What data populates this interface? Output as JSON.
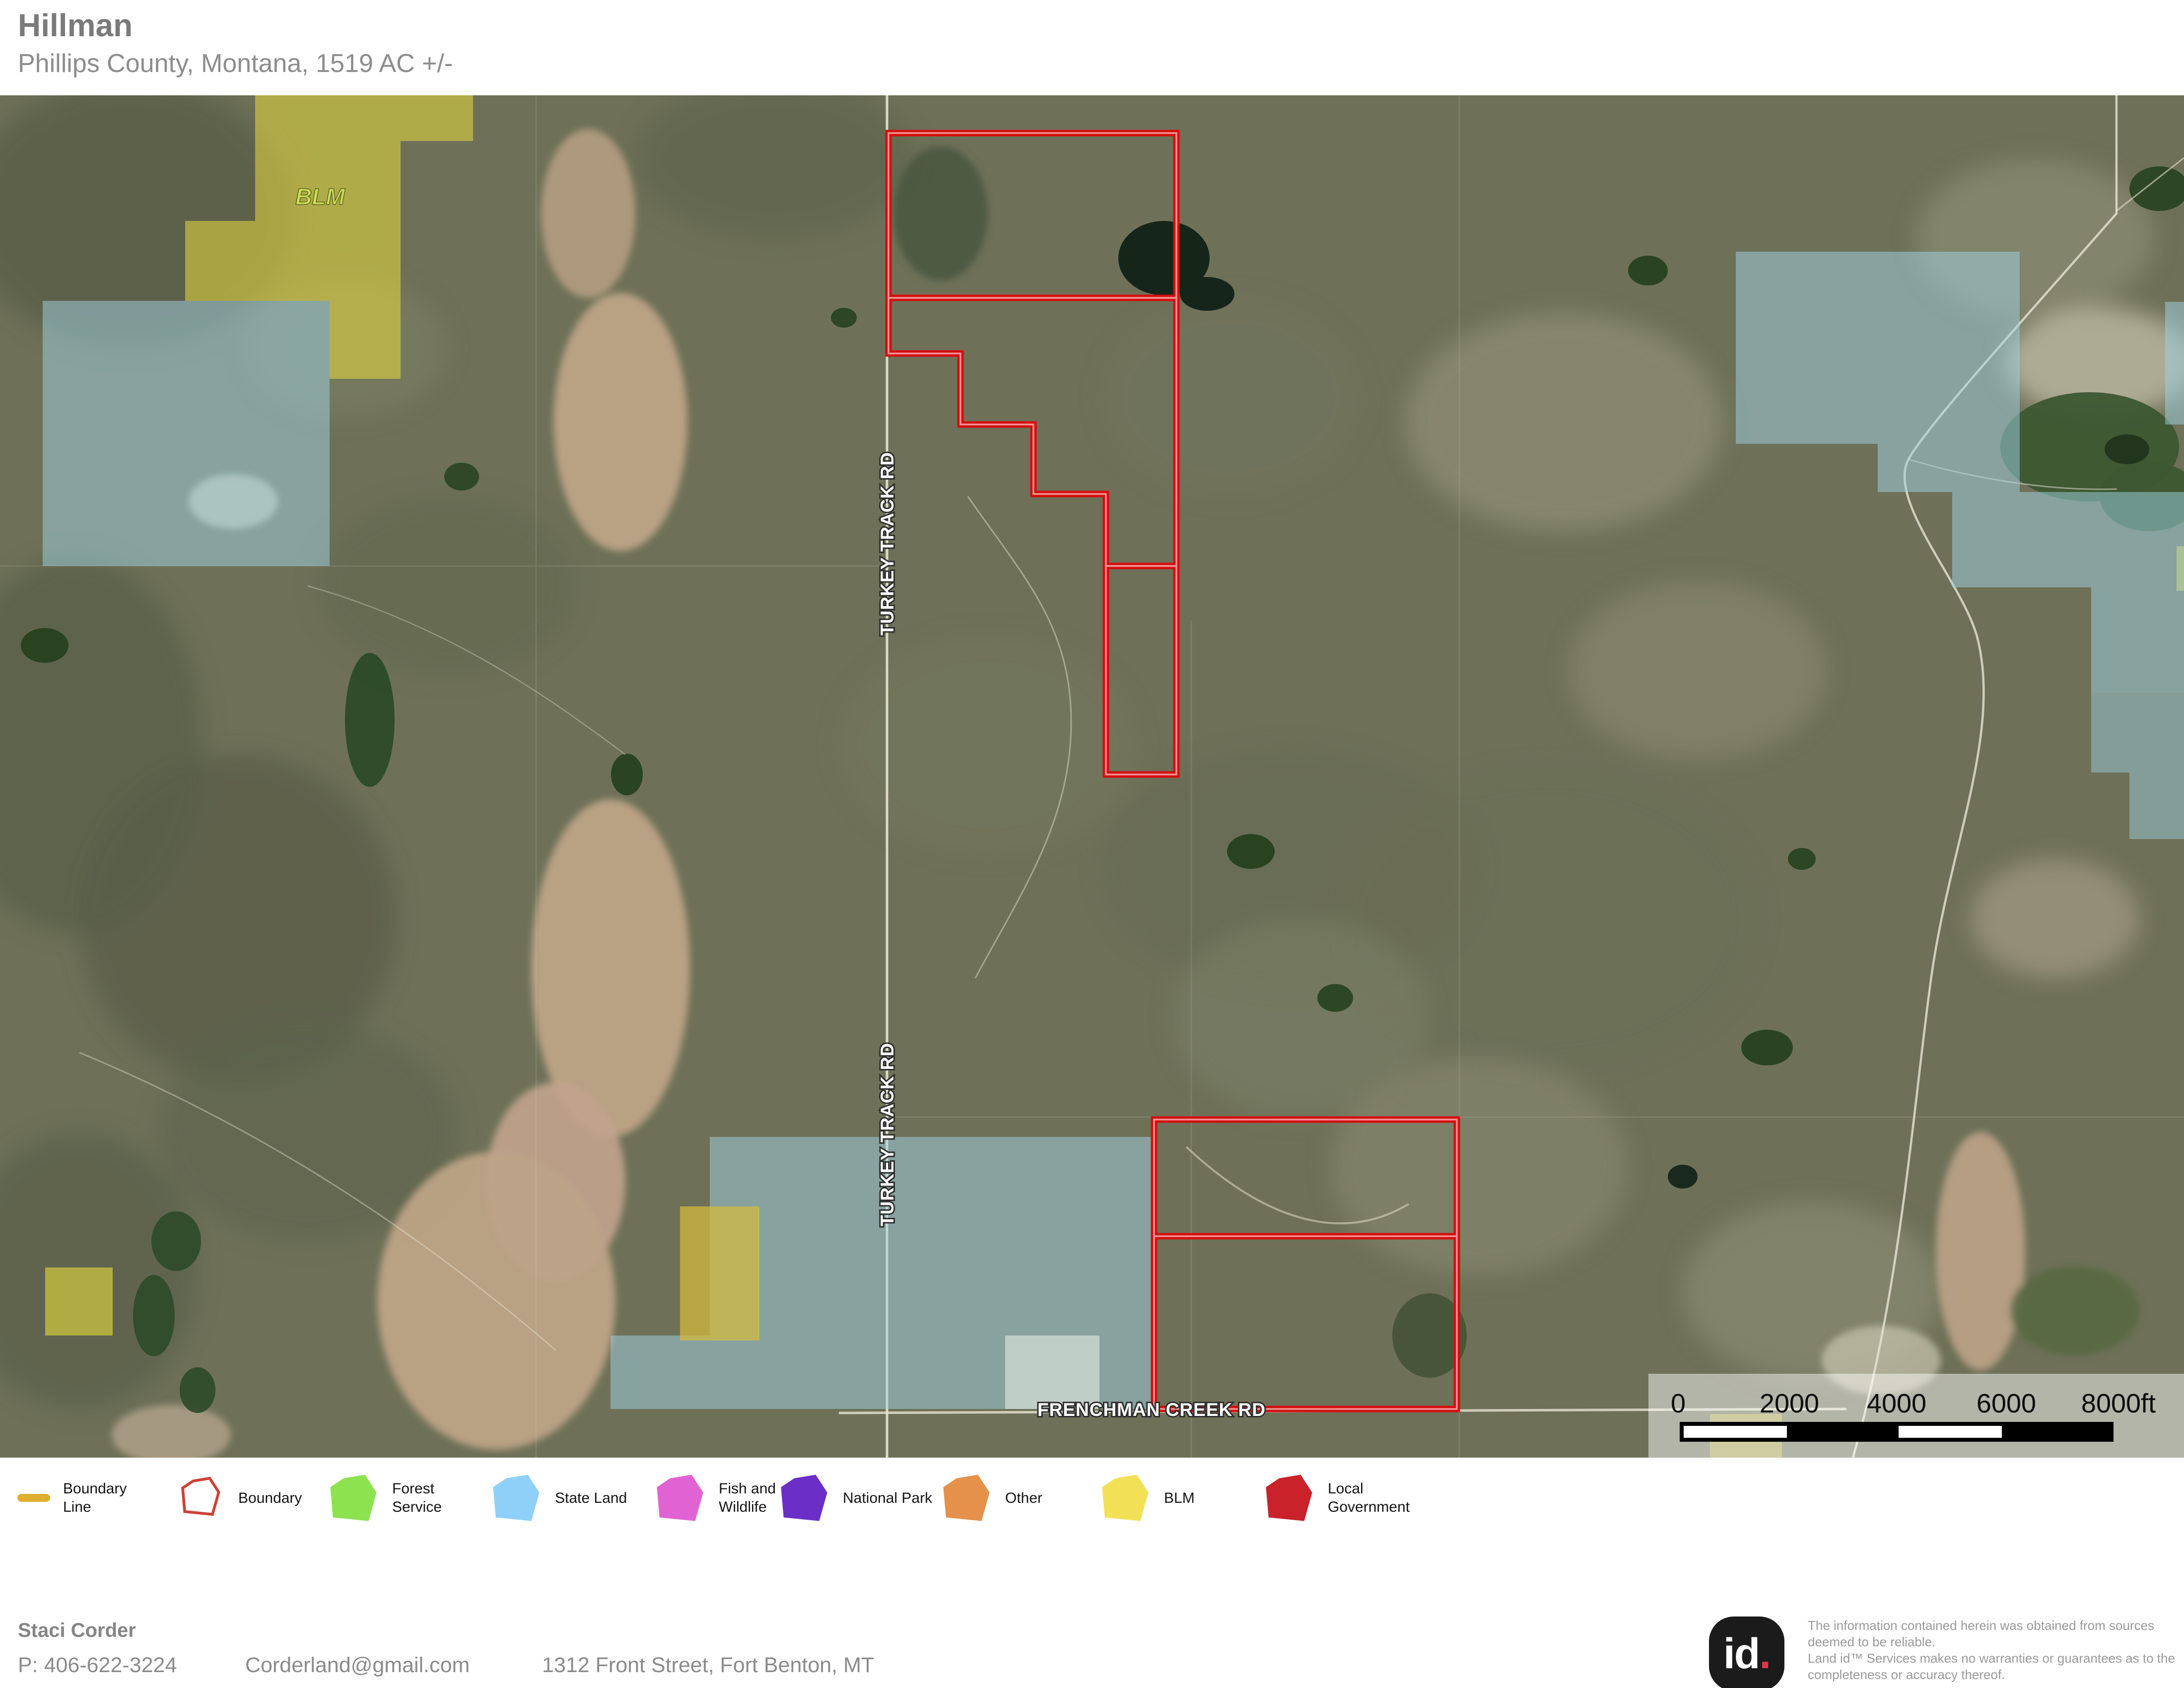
{
  "header": {
    "title": "Hillman",
    "subtitle": "Phillips County, Montana, 1519 AC +/-"
  },
  "map": {
    "area_labels": {
      "blm": "BLM"
    },
    "road_labels": {
      "turkey_track": "TURKEY TRACK RD",
      "frenchman_creek": "FRENCHMAN CREEK RD"
    },
    "scalebar": {
      "ticks": [
        "0",
        "2000",
        "4000",
        "6000",
        "8000ft"
      ]
    }
  },
  "legend": {
    "items": [
      {
        "name": "boundary-line",
        "lines": [
          "Boundary",
          "Line"
        ],
        "type": "line",
        "color": "#dfae2e"
      },
      {
        "name": "boundary",
        "lines": [
          "Boundary"
        ],
        "type": "outline",
        "color": "#cf4038"
      },
      {
        "name": "forest-service",
        "lines": [
          "Forest",
          "Service"
        ],
        "type": "poly",
        "color": "#8ce34f"
      },
      {
        "name": "state-land",
        "lines": [
          "State Land"
        ],
        "type": "poly",
        "color": "#8fd0f8"
      },
      {
        "name": "fish-and-wildlife",
        "lines": [
          "Fish and",
          "Wildlife"
        ],
        "type": "poly",
        "color": "#e163d3"
      },
      {
        "name": "national-park",
        "lines": [
          "National Park"
        ],
        "type": "poly",
        "color": "#6b2fc7"
      },
      {
        "name": "other",
        "lines": [
          "Other"
        ],
        "type": "poly",
        "color": "#e5914c"
      },
      {
        "name": "blm",
        "lines": [
          "BLM"
        ],
        "type": "poly",
        "color": "#f2e156"
      },
      {
        "name": "local-government",
        "lines": [
          "Local",
          "Government"
        ],
        "type": "poly",
        "color": "#c9222a"
      }
    ]
  },
  "footer": {
    "agent_name": "Staci Corder",
    "phone": "P: 406-622-3224",
    "email": "Corderland@gmail.com",
    "address": "1312 Front Street, Fort Benton, MT"
  },
  "branding": {
    "logo_id": "id",
    "logo_dot": ".",
    "disclaimer_lines": [
      "The information contained herein was obtained from sources",
      "deemed to be reliable.",
      " Land id™ Services makes no warranties or guarantees as to the",
      "completeness or accuracy thereof."
    ]
  },
  "theme": {
    "boundary_red": "#d60d0d",
    "boundary_red_inner": "#f2a3a3",
    "blm_yellow": "#e8da3e",
    "state_blue": "#9fd3e6",
    "map_base": "#6e7158",
    "road_white": "#e9e6d4",
    "blm_label": "#cfe457",
    "title_gray": "#7a7a7a",
    "text_gray": "#8d8d8d"
  }
}
